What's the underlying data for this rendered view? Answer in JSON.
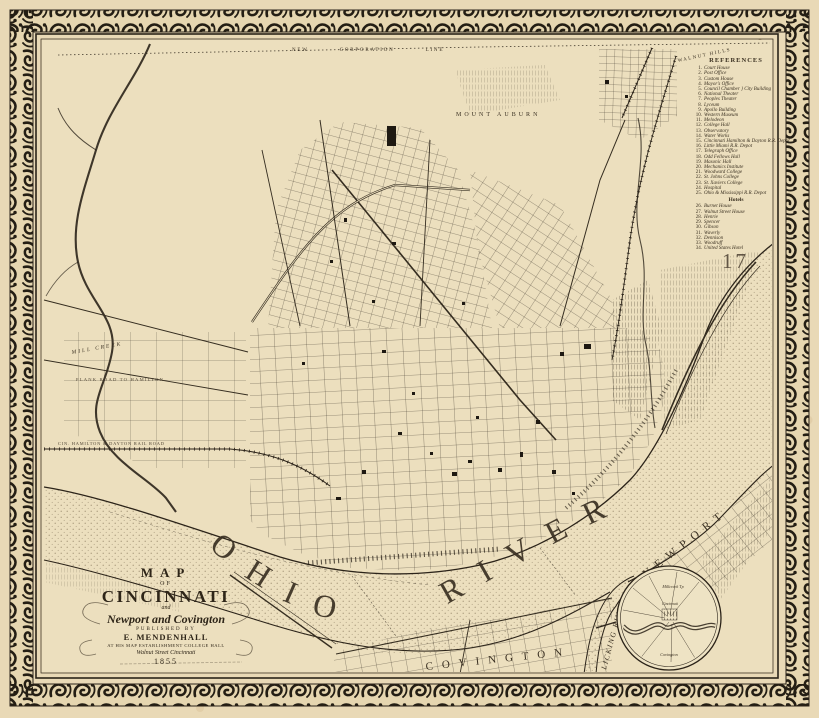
{
  "colors": {
    "paper": "#e9d9b6",
    "map_field": "#ecdfbe",
    "ink": "#2b2319",
    "stipple": "#6a5a40"
  },
  "map": {
    "plate_number": "17",
    "labels": {
      "ohio_river": "OHIO RIVER",
      "licking_river": "LICKING RIVER",
      "newport": "NEWPORT",
      "covington": "COVINGTON",
      "mill_creek": "MILL CREEK",
      "mount_auburn": "MOUNT AUBURN",
      "walnut_hills": "WALNUT HILLS",
      "corporation_line": "NEW CORPORATION LINE",
      "plank_road": "PLANK ROAD TO HAMILTON",
      "railroad": "CIN. HAMILTON & DAYTON RAIL ROAD"
    },
    "inset": {
      "millcreek": "Millcreek Tp",
      "cincinnati": "Cincinnati",
      "covington": "Covington"
    }
  },
  "cartouche": {
    "line1": "MAP",
    "line2": "OF",
    "title": "CINCINNATI",
    "line_and": "and",
    "subtitle": "Newport and Covington",
    "published_by": "PUBLISHED BY",
    "publisher": "E. MENDENHALL",
    "address1": "AT HIS MAP ESTABLISHMENT COLLEGE HALL",
    "address2": "Walnut Street Cincinnati",
    "year": "1855"
  },
  "references": {
    "title": "REFERENCES",
    "items": [
      {
        "n": "1.",
        "t": "Court House"
      },
      {
        "n": "2.",
        "t": "Post Office"
      },
      {
        "n": "3.",
        "t": "Custom House"
      },
      {
        "n": "4.",
        "t": "Mayor's Office"
      },
      {
        "n": "5.",
        "t": "Council Chamber } City Building"
      },
      {
        "n": "6.",
        "t": "National Theater"
      },
      {
        "n": "7.",
        "t": "Peoples Theater"
      },
      {
        "n": "8.",
        "t": "Lyceum"
      },
      {
        "n": "9.",
        "t": "Apollo Building"
      },
      {
        "n": "10.",
        "t": "Western Museum"
      },
      {
        "n": "11.",
        "t": "Melodeon"
      },
      {
        "n": "12.",
        "t": "College Hall"
      },
      {
        "n": "13.",
        "t": "Observatory"
      },
      {
        "n": "14.",
        "t": "Water Works"
      },
      {
        "n": "15.",
        "t": "Cincinnati Hamilton & Dayton R.R. Depot"
      },
      {
        "n": "16.",
        "t": "Little Miami R.R. Depot"
      },
      {
        "n": "17.",
        "t": "Telegraph Office"
      },
      {
        "n": "18.",
        "t": "Odd Fellows Hall"
      },
      {
        "n": "19.",
        "t": "Masonic Hall"
      },
      {
        "n": "20.",
        "t": "Mechanics Institute"
      },
      {
        "n": "21.",
        "t": "Woodward College"
      },
      {
        "n": "22.",
        "t": "St. Johns College"
      },
      {
        "n": "23.",
        "t": "St. Xaviers College"
      },
      {
        "n": "24.",
        "t": "Hospital"
      },
      {
        "n": "25.",
        "t": "Ohio & Mississippi R.R. Depot"
      }
    ],
    "hotels_title": "Hotels",
    "hotels": [
      {
        "n": "26.",
        "t": "Burnet House"
      },
      {
        "n": "27.",
        "t": "Walnut Street House"
      },
      {
        "n": "28.",
        "t": "Henrie"
      },
      {
        "n": "29.",
        "t": "Spencer"
      },
      {
        "n": "30.",
        "t": "Gibson"
      },
      {
        "n": "31.",
        "t": "Waverly"
      },
      {
        "n": "32.",
        "t": "Dennison"
      },
      {
        "n": "33.",
        "t": "Woodruff"
      },
      {
        "n": "34.",
        "t": "United States Hotel"
      }
    ]
  }
}
